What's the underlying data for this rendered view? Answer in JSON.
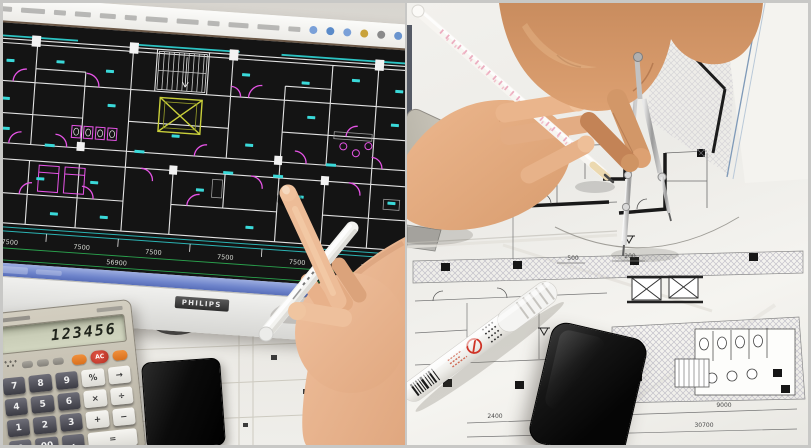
{
  "left_photo": {
    "monitor_brand": "PHILIPS",
    "cad_dimensions": {
      "segments": [
        "7500",
        "7500",
        "7500",
        "7500",
        "7500",
        "7000"
      ],
      "total": "56900"
    },
    "calculator": {
      "display": "123456",
      "ac_key": "AC",
      "digit_keys": [
        "7",
        "8",
        "9",
        "4",
        "5",
        "6",
        "1",
        "2",
        "3",
        "0",
        "00",
        "."
      ],
      "operator_keys": [
        "%",
        "→",
        "×",
        "÷",
        "+",
        "−",
        "="
      ]
    }
  },
  "right_photo": {
    "blueprint_dimensions": {
      "top_small": [
        "500",
        "200"
      ],
      "bottom": [
        "2400",
        "9000",
        "30700"
      ]
    },
    "calculator_visible_keys": [
      "0",
      "0",
      "1",
      "4"
    ]
  },
  "palette": {
    "cad_wall": "#e2e2e2",
    "cad_door_magenta": "#e654e6",
    "cad_label_cyan": "#3ad9d9",
    "cad_elevator_yellow": "#c9cf3a",
    "cad_dimension_green": "#2aa14d",
    "taskbar_blue": "#6e84cb",
    "marker_warning_red": "#cf3326"
  }
}
